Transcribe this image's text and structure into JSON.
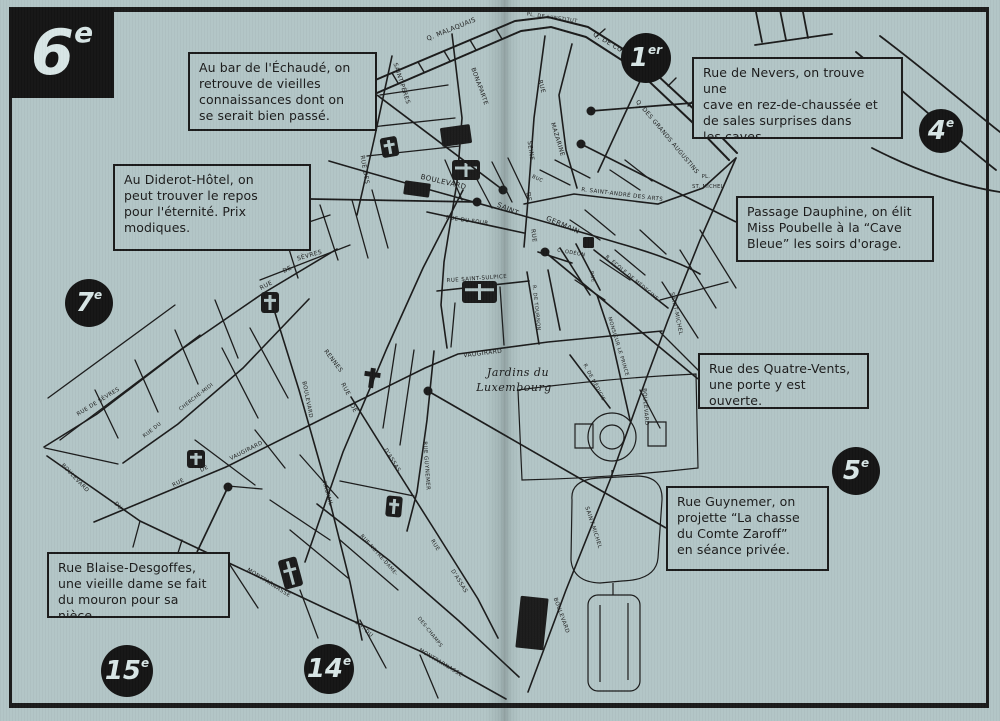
{
  "page": {
    "bg": "#b2c5c6",
    "ink": "#1b1b1b",
    "arrondissement_title": "6e"
  },
  "badges": [
    {
      "num": "6",
      "sup": "e"
    },
    {
      "num": "1",
      "sup": "er"
    },
    {
      "num": "4",
      "sup": "e"
    },
    {
      "num": "7",
      "sup": "e"
    },
    {
      "num": "5",
      "sup": "e"
    },
    {
      "num": "15",
      "sup": "e"
    },
    {
      "num": "14",
      "sup": "e"
    }
  ],
  "callouts": [
    {
      "id": "echaude",
      "lines": [
        "Au bar de l'Échaudé, on",
        "retrouve de vieilles",
        "connaissances dont on",
        "se serait bien passé."
      ],
      "leader": {
        "x1": 377,
        "y1": 95,
        "x2": 503,
        "y2": 190
      },
      "dot": {
        "x": 503,
        "y": 190
      }
    },
    {
      "id": "diderot",
      "lines": [
        "Au Diderot-Hôtel, on",
        "peut trouver le repos",
        "pour l'éternité. Prix",
        "modiques."
      ],
      "leader": {
        "x1": 311,
        "y1": 199,
        "x2": 477,
        "y2": 202
      },
      "dot": {
        "x": 477,
        "y": 202
      }
    },
    {
      "id": "nevers",
      "lines": [
        "Rue de Nevers, on trouve une",
        "cave en rez-de-chaussée et",
        "de sales surprises dans",
        "les caves."
      ],
      "leader": {
        "x1": 692,
        "y1": 103,
        "x2": 591,
        "y2": 111
      },
      "dot": {
        "x": 591,
        "y": 111
      }
    },
    {
      "id": "dauphine",
      "lines": [
        "Passage Dauphine, on élit",
        "Miss Poubelle à la “Cave",
        "Bleue” les soirs d'orage."
      ],
      "leader": {
        "x1": 736,
        "y1": 222,
        "x2": 581,
        "y2": 144
      },
      "dot": {
        "x": 581,
        "y": 144
      }
    },
    {
      "id": "quatre-vents",
      "lines": [
        "Rue des Quatre-Vents,",
        "une porte y est ouverte."
      ],
      "leader": {
        "x1": 698,
        "y1": 379,
        "x2": 545,
        "y2": 252
      },
      "dot": {
        "x": 545,
        "y": 252
      }
    },
    {
      "id": "guynemer",
      "lines": [
        "Rue Guynemer, on",
        "projette “La chasse",
        "du Comte Zaroff”",
        "en séance privée."
      ],
      "leader": {
        "x1": 666,
        "y1": 528,
        "x2": 428,
        "y2": 391
      },
      "dot": {
        "x": 428,
        "y": 391
      }
    },
    {
      "id": "blaise-desgoffes",
      "lines": [
        "Rue Blaise-Desgoffes,",
        "une vieille dame se fait",
        "du mouron pour sa nièce."
      ],
      "leader": {
        "x1": 197,
        "y1": 552,
        "x2": 228,
        "y2": 487
      },
      "dot": {
        "x": 228,
        "y": 487
      }
    }
  ],
  "map": {
    "garden_label": [
      "Jardins du",
      "Luxembourg"
    ],
    "street_labels": [
      {
        "t": "Q. MALAQUAIS",
        "x": 452,
        "y": 31,
        "r": -22,
        "s": 6.5
      },
      {
        "t": "PL. DE L'INSTITUT",
        "x": 552,
        "y": 19,
        "r": 8,
        "s": 5
      },
      {
        "t": "Q. DE CONTI",
        "x": 612,
        "y": 47,
        "r": 31,
        "s": 6.5
      },
      {
        "t": "Q. DES GRANDS AUGUSTINS",
        "x": 666,
        "y": 138,
        "r": 50,
        "s": 6
      },
      {
        "t": "PL.",
        "x": 706,
        "y": 178,
        "r": 0,
        "s": 5
      },
      {
        "t": "ST. MICHEL",
        "x": 708,
        "y": 188,
        "r": 0,
        "s": 5
      },
      {
        "t": "SAINT-PÈRES",
        "x": 400,
        "y": 84,
        "r": 72,
        "s": 6
      },
      {
        "t": "RUE DES",
        "x": 363,
        "y": 170,
        "r": 80,
        "s": 6
      },
      {
        "t": "BONAPARTE",
        "x": 478,
        "y": 87,
        "r": 70,
        "s": 6
      },
      {
        "t": "RUE",
        "x": 540,
        "y": 87,
        "r": 75,
        "s": 6
      },
      {
        "t": "MAZARINE",
        "x": 556,
        "y": 140,
        "r": 73,
        "s": 6
      },
      {
        "t": "SEINE",
        "x": 529,
        "y": 151,
        "r": 82,
        "s": 6
      },
      {
        "t": "DE",
        "x": 527,
        "y": 197,
        "r": 82,
        "s": 6
      },
      {
        "t": "RUE",
        "x": 532,
        "y": 236,
        "r": 82,
        "s": 6
      },
      {
        "t": "BUC",
        "x": 537,
        "y": 180,
        "r": 25,
        "s": 5
      },
      {
        "t": "R. SAINT-ANDRÉ DES ARTS",
        "x": 622,
        "y": 196,
        "r": 7,
        "s": 5.5
      },
      {
        "t": "BOULEVARD",
        "x": 443,
        "y": 184,
        "r": 13,
        "s": 7
      },
      {
        "t": "SAINT",
        "x": 507,
        "y": 211,
        "r": 24,
        "s": 7
      },
      {
        "t": "GERMAIN",
        "x": 562,
        "y": 227,
        "r": 23,
        "s": 7
      },
      {
        "t": "RUE DU FOUR",
        "x": 467,
        "y": 222,
        "r": 8,
        "s": 5.5
      },
      {
        "t": "RUE SAINT-SULPICE",
        "x": 477,
        "y": 280,
        "r": -4,
        "s": 5.5
      },
      {
        "t": "R. DE TOURNON",
        "x": 535,
        "y": 308,
        "r": 84,
        "s": 5
      },
      {
        "t": "C. ODÉON",
        "x": 571,
        "y": 254,
        "r": 10,
        "s": 5
      },
      {
        "t": "RUE",
        "x": 591,
        "y": 277,
        "r": 80,
        "s": 5
      },
      {
        "t": "R. ÉCOLE DE MÉDECINE",
        "x": 631,
        "y": 279,
        "r": 40,
        "s": 5
      },
      {
        "t": "MONSIEUR LE PRINCE",
        "x": 617,
        "y": 347,
        "r": 73,
        "s": 5
      },
      {
        "t": "SAINT-MICHEL",
        "x": 675,
        "y": 314,
        "r": 78,
        "s": 5.5
      },
      {
        "t": "R. DE MÉDICIS",
        "x": 593,
        "y": 383,
        "r": 62,
        "s": 5
      },
      {
        "t": "BOULEVARD",
        "x": 644,
        "y": 407,
        "r": 86,
        "s": 5.5
      },
      {
        "t": "SAINT-MICHEL",
        "x": 592,
        "y": 528,
        "r": 72,
        "s": 5.5
      },
      {
        "t": "BOULEVARD",
        "x": 560,
        "y": 616,
        "r": 70,
        "s": 5.5
      },
      {
        "t": "VAUGIRARD",
        "x": 483,
        "y": 355,
        "r": -7,
        "s": 6
      },
      {
        "t": "RUE GUYNEMER",
        "x": 425,
        "y": 466,
        "r": 86,
        "s": 5.5
      },
      {
        "t": "D'ASSAS",
        "x": 391,
        "y": 461,
        "r": 58,
        "s": 5.5
      },
      {
        "t": "RUE",
        "x": 434,
        "y": 546,
        "r": 58,
        "s": 5.5
      },
      {
        "t": "D'ASSAS",
        "x": 458,
        "y": 582,
        "r": 58,
        "s": 5.5
      },
      {
        "t": "RENNES",
        "x": 332,
        "y": 362,
        "r": 53,
        "s": 6
      },
      {
        "t": "RUE",
        "x": 344,
        "y": 390,
        "r": 62,
        "s": 6
      },
      {
        "t": "DE",
        "x": 352,
        "y": 409,
        "r": 62,
        "s": 6
      },
      {
        "t": "BOULEVARD",
        "x": 306,
        "y": 400,
        "r": 79,
        "s": 5.5
      },
      {
        "t": "RASPAIL",
        "x": 326,
        "y": 494,
        "r": 74,
        "s": 5.5
      },
      {
        "t": "RUE NOTRE-DAME-",
        "x": 378,
        "y": 556,
        "r": 48,
        "s": 5
      },
      {
        "t": "DES-CHAMPS",
        "x": 429,
        "y": 633,
        "r": 52,
        "s": 5
      },
      {
        "t": "MONTPARNASSE",
        "x": 268,
        "y": 584,
        "r": 32,
        "s": 5.5
      },
      {
        "t": "BD. DU",
        "x": 363,
        "y": 630,
        "r": 42,
        "s": 5.5
      },
      {
        "t": "MONTPARNASSE",
        "x": 440,
        "y": 664,
        "r": 31,
        "s": 5.5
      },
      {
        "t": "BOULEVARD",
        "x": 74,
        "y": 479,
        "r": 46,
        "s": 5.5
      },
      {
        "t": "DU",
        "x": 117,
        "y": 507,
        "r": 46,
        "s": 5.5
      },
      {
        "t": "RUE DE SÈVRES",
        "x": 99,
        "y": 403,
        "r": -32,
        "s": 5.5
      },
      {
        "t": "SÈVRES",
        "x": 310,
        "y": 257,
        "r": -16,
        "s": 6
      },
      {
        "t": "DE",
        "x": 288,
        "y": 271,
        "r": -25,
        "s": 6
      },
      {
        "t": "RUE",
        "x": 267,
        "y": 287,
        "r": -28,
        "s": 6
      },
      {
        "t": "CHERCHE-MIDI",
        "x": 197,
        "y": 398,
        "r": -38,
        "s": 5
      },
      {
        "t": "RUE DU",
        "x": 153,
        "y": 431,
        "r": -38,
        "s": 5
      },
      {
        "t": "RUE",
        "x": 179,
        "y": 484,
        "r": -28,
        "s": 5.5
      },
      {
        "t": "DE",
        "x": 205,
        "y": 470,
        "r": -28,
        "s": 5.5
      },
      {
        "t": "VAUGIRARD",
        "x": 247,
        "y": 452,
        "r": -27,
        "s": 5.5
      }
    ],
    "landmarks": [
      {
        "k": "church",
        "x": 381,
        "y": 137,
        "w": 17,
        "h": 20,
        "r": -10
      },
      {
        "k": "church",
        "x": 452,
        "y": 160,
        "w": 28,
        "h": 20,
        "r": 0
      },
      {
        "k": "church",
        "x": 462,
        "y": 281,
        "w": 35,
        "h": 22,
        "r": 0
      },
      {
        "k": "church",
        "x": 261,
        "y": 292,
        "w": 18,
        "h": 21,
        "r": 0
      },
      {
        "k": "church",
        "x": 187,
        "y": 450,
        "w": 18,
        "h": 18,
        "r": 0
      },
      {
        "k": "cross",
        "x": 364,
        "y": 368,
        "w": 16,
        "h": 20,
        "r": 8
      },
      {
        "k": "church",
        "x": 386,
        "y": 496,
        "w": 16,
        "h": 21,
        "r": 5
      },
      {
        "k": "church",
        "x": 281,
        "y": 558,
        "w": 19,
        "h": 30,
        "r": -15
      },
      {
        "k": "block",
        "x": 441,
        "y": 126,
        "w": 30,
        "h": 19,
        "r": -8
      },
      {
        "k": "block",
        "x": 404,
        "y": 182,
        "w": 26,
        "h": 14,
        "r": 8
      },
      {
        "k": "block",
        "x": 518,
        "y": 597,
        "w": 28,
        "h": 52,
        "r": 6
      },
      {
        "k": "block",
        "x": 583,
        "y": 237,
        "w": 11,
        "h": 11,
        "r": 0
      }
    ]
  }
}
